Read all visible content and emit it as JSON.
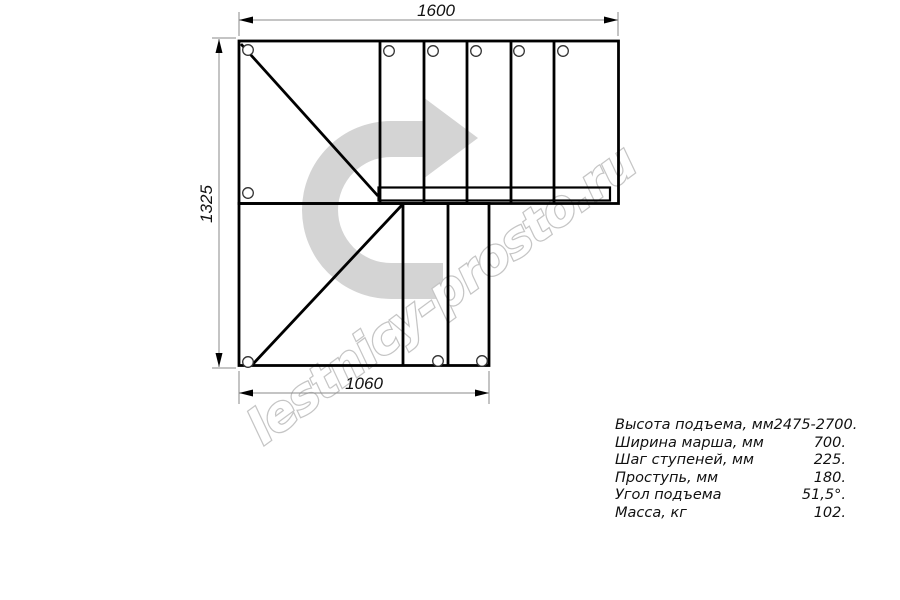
{
  "page": {
    "background": "#ffffff"
  },
  "drawing": {
    "type": "staircase-plan-top-view",
    "dimensions_mm": {
      "top_width": "1600",
      "left_height": "1325",
      "bottom_width": "1060"
    },
    "icons": {
      "direction_arrow": "u-turn-right-arrow"
    },
    "colors": {
      "outline": "#000000",
      "dimension_lines": "#8a8a8a",
      "arrow_fill": "#d4d4d4",
      "watermark_stroke": "#c5c5c5"
    }
  },
  "specs": {
    "rows": [
      {
        "label": "Высота подъема, мм",
        "value": "2475-2700."
      },
      {
        "label": "Ширина марша, мм",
        "value": "700."
      },
      {
        "label": "Шаг ступеней, мм",
        "value": "225."
      },
      {
        "label": "Проступь, мм",
        "value": "180."
      },
      {
        "label": "Угол подъема",
        "value": "51,5°."
      },
      {
        "label": "Масса, кг",
        "value": "102."
      }
    ]
  },
  "watermark": {
    "text": "lestnicy-prosto.ru"
  }
}
